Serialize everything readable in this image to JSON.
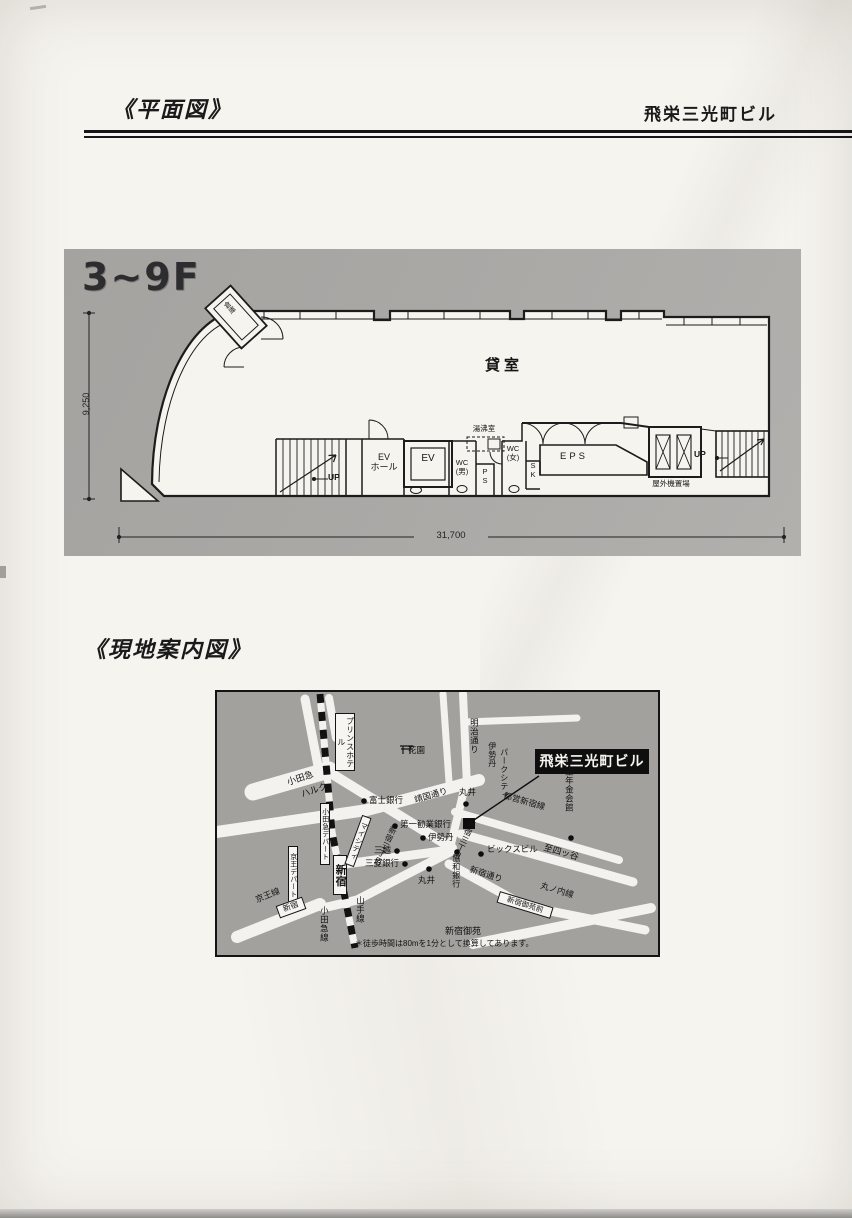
{
  "header": {
    "left_title": "《平面図》",
    "right_title": "飛栄三光町ビル"
  },
  "floor_plan": {
    "floor_range": "3~9F",
    "main_room": "貸室",
    "storage": "倉庫",
    "up_left": "UP",
    "up_right": "UP",
    "ev_hall": "EV\nホール",
    "ev": "EV",
    "hot_water_room": "湯沸室",
    "wc_men": "WC\n(男)",
    "pipe_shaft": "P\nS",
    "wc_women": "WC\n(女)",
    "sink": "S\nK",
    "eps": "EPS",
    "outdoor_unit_area": "屋外機置場",
    "width_dim": "31,700",
    "height_dim": "9,250"
  },
  "site_map": {
    "section_title": "《現地案内図》",
    "building_label": "飛栄三光町ビル",
    "note": "＊徒歩時間は80mを1分として換算してあります。",
    "labels": {
      "prince_hotel": "プリンスホテル",
      "odakyu_halc_1": "小田急",
      "odakyu_halc_2": "ハルク",
      "meiji_dori": "明治通り",
      "isetan_parkcity_1": "伊勢丹",
      "isetan_parkcity_2": "パークシティ",
      "hanazono": "花園",
      "kosei_nenkin_kaikan": "厚生年金会館",
      "fuji_bank": "富士銀行",
      "yasukuni_dori": "靖国通り",
      "marui_top": "丸井",
      "daiichi_kangyo_bank": "第一勧業銀行",
      "toei_shinjuku_line": "都営新宿線",
      "shinjuku_3chome_w": "新宿三丁目",
      "shinjuku_3chome_e": "新宿三丁目",
      "isetan": "伊勢丹",
      "mitsukoshi": "三越",
      "mitsubishi_bank": "三菱銀行",
      "bics_bldg": "ビックスビル",
      "kyowa_bank": "協和銀行",
      "marui_bottom": "丸井",
      "shinjuku_dori": "新宿通り",
      "to_yotsuya": "至四ッ谷",
      "marunouchi_line": "丸ノ内線",
      "gyoemmae_station": "新宿御苑前",
      "shinjuku_gyoen": "新宿御苑",
      "mycity": "マイシティ",
      "odakyu_depart": "小田急デパート",
      "keio_depart": "京王デパート",
      "shinjuku_station_jr": "新宿",
      "shinjuku_station_keio": "新宿",
      "keio_line": "京王線",
      "yamanote_line": "山手線",
      "odakyu_line": "小田急線"
    }
  }
}
